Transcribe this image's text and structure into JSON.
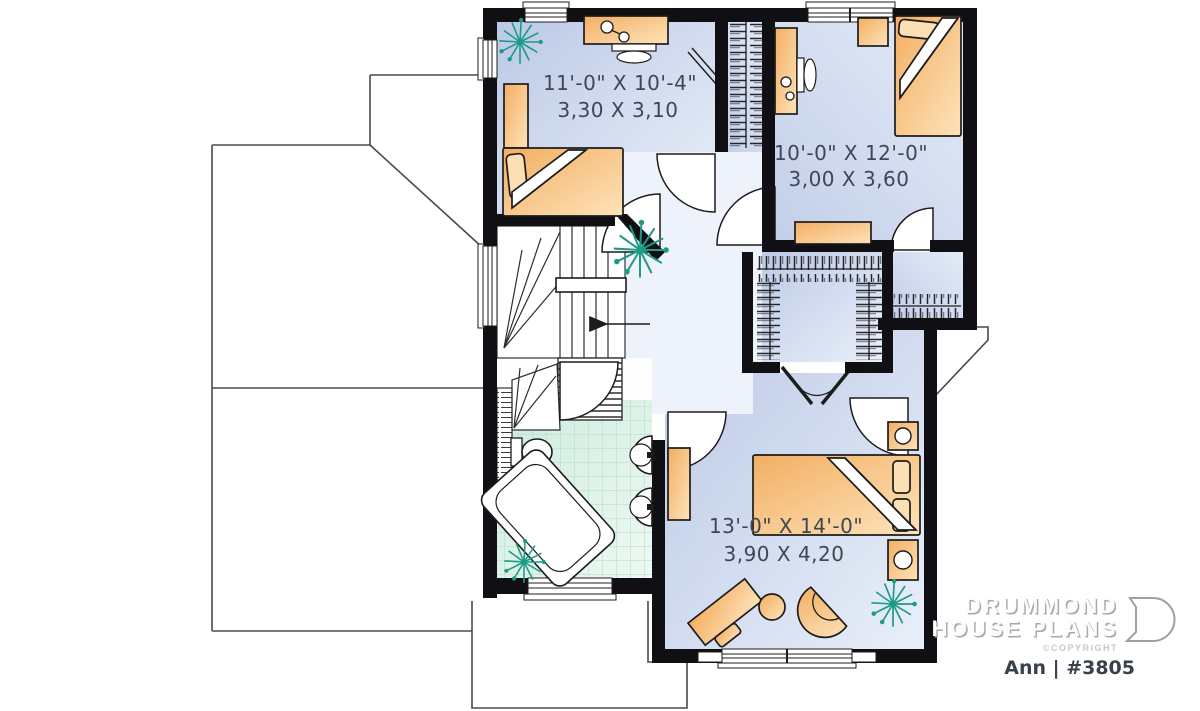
{
  "plan": {
    "type": "second-floor plan drawing",
    "rooms": [
      {
        "id": "bedroom-top-left",
        "imperial": "11'-0\" X 10'-4\"",
        "metric": "3,30 X 3,10"
      },
      {
        "id": "bedroom-top-right",
        "imperial": "10'-0\" X 12'-0\"",
        "metric": "3,00 X 3,60"
      },
      {
        "id": "master-bedroom",
        "imperial": "13'-0\" X 14'-0\"",
        "metric": "3,90 X 4,20"
      }
    ],
    "branding": {
      "brand_line1": "DRUMMOND",
      "brand_line2": "HOUSE PLANS",
      "copyright": "©COPYRIGHT",
      "plan_name": "Ann | #3805"
    },
    "colors": {
      "wall": "#101014",
      "floor_blue_dark": "#bfcce8",
      "floor_blue_light": "#e7edf8",
      "furniture_orange_dark": "#f3ae62",
      "furniture_orange_light": "#fde3ba",
      "bath_tile_dark": "#cdeadd",
      "bath_tile_light": "#eef9f3",
      "tile_grid": "#aedcc3",
      "plant_teal": "#1d9a88",
      "label_ink": "#3e4754",
      "roofline_gray": "#4a4a4a"
    }
  }
}
